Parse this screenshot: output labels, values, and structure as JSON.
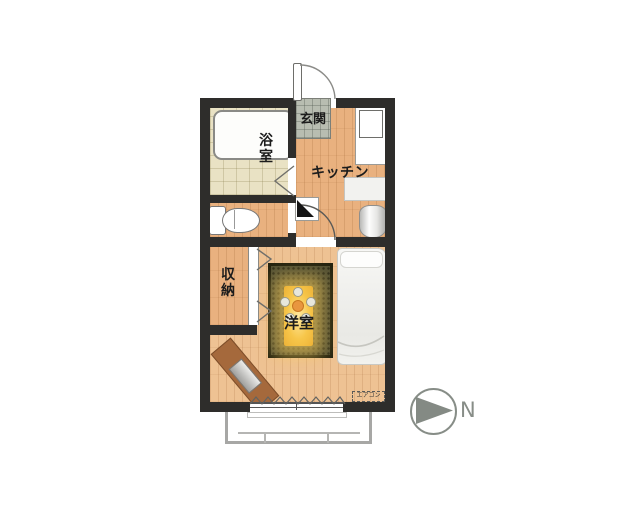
{
  "floorplan": {
    "rooms": {
      "entrance_label": "玄関",
      "bathroom_label": "浴室",
      "kitchen_label": "キッチン",
      "storage_label": "収納",
      "western_room_label": "洋室"
    },
    "annotations": {
      "aircon_label": "エアコン",
      "compass_north_label": "N"
    },
    "colors": {
      "wall": "#2e2d2b",
      "kitchen_floor": "#e9b17f",
      "bedroom_floor": "#eec293",
      "bathroom_floor": "#e9e2c4",
      "entrance_tile": "#b8bdb1",
      "rug": "#514f33",
      "light_glow": "#f7c64a",
      "desk": "#a5693c",
      "compass_gray": "#878d87"
    }
  }
}
